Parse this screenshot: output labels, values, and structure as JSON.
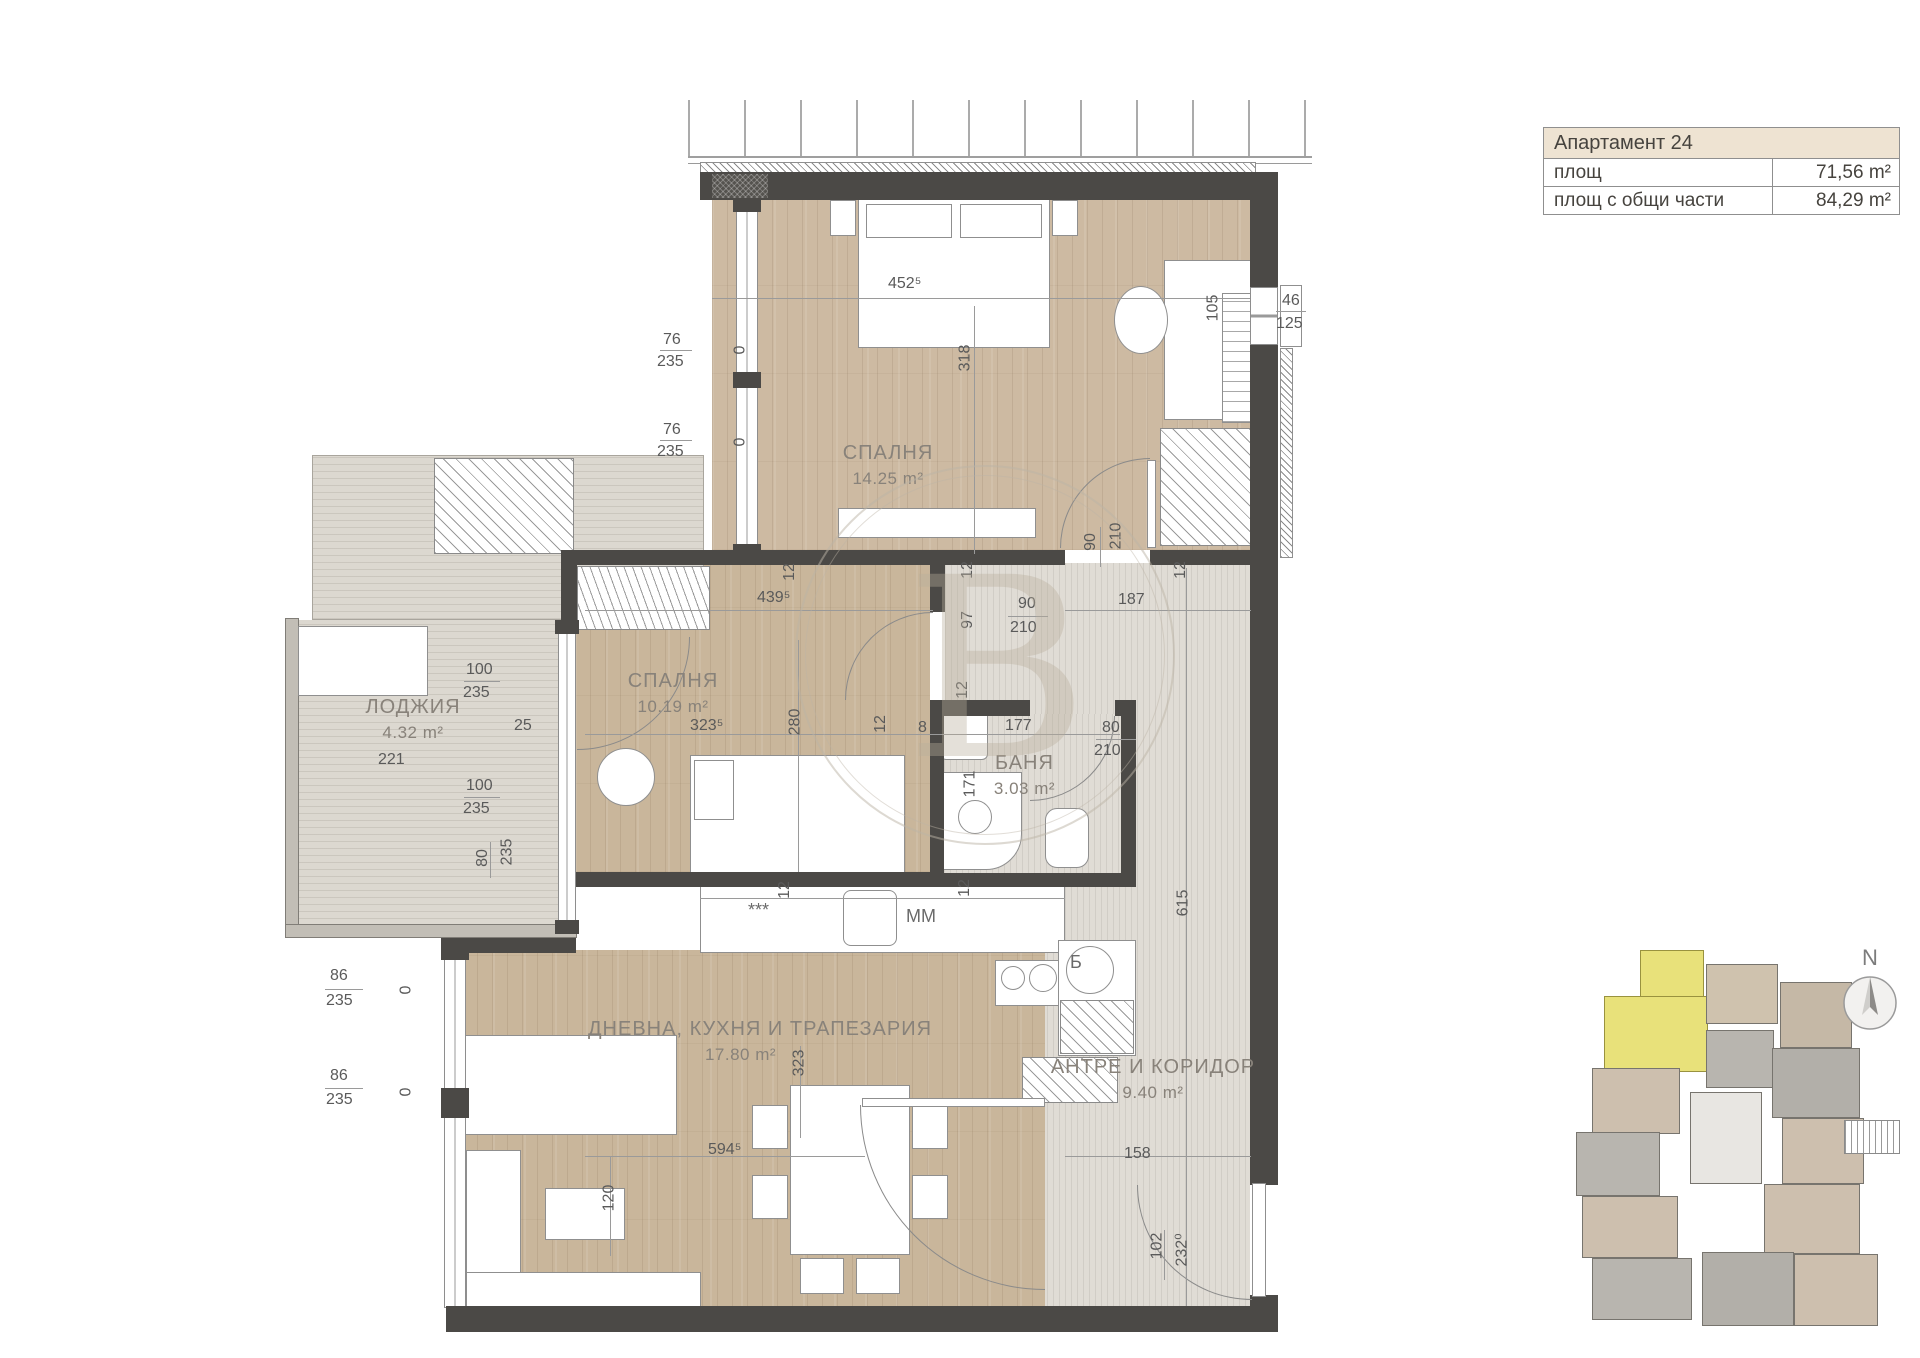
{
  "info_table": {
    "title": "Апартамент 24",
    "rows": [
      {
        "label": "площ",
        "value": "71,56 m²"
      },
      {
        "label": "площ с общи части",
        "value": "84,29 m²"
      }
    ]
  },
  "rooms": {
    "bedroom1": {
      "name": "СПАЛНЯ",
      "area": "14.25 m²"
    },
    "bedroom2": {
      "name": "СПАЛНЯ",
      "area": "10.19 m²"
    },
    "loggia": {
      "name": "ЛОДЖИЯ",
      "area": "4.32 m²"
    },
    "bath": {
      "name": "БАНЯ",
      "area": "3.03 m²"
    },
    "living": {
      "name": "ДНЕВНА, КУХНЯ И ТРАПЕЗАРИЯ",
      "area": "17.80 m²"
    },
    "hall": {
      "name": "АНТРЕ И КОРИДОР",
      "area": "9.40 m²"
    }
  },
  "dims": {
    "bed1_w": "452⁵",
    "bed1_h": "318",
    "desk": "105",
    "win_r_w": "46",
    "win_r_h": "125",
    "win76": "76",
    "win235": "235",
    "zero": "0",
    "bed2_w": "439⁵",
    "bed2_323": "323⁵",
    "bed2_280": "280",
    "door_90": "90",
    "door_210": "210",
    "d12": "12",
    "d97": "97",
    "d187": "187",
    "d615": "615",
    "log_100": "100",
    "log_221": "221",
    "log_25": "25",
    "log_80": "80",
    "bath_8": "8",
    "bath_177": "177",
    "bath_80": "80",
    "bath_210": "210",
    "bath_171": "171",
    "liv_323": "323",
    "liv_594": "594⁵",
    "liv_120": "120",
    "win86": "86",
    "hall_158": "158",
    "hall_102": "102",
    "hall_232": "232⁰"
  },
  "annotations": {
    "dishwasher": "***",
    "washing_machine": "MM",
    "boiler": "Б"
  },
  "minimap": {
    "north": "N"
  },
  "watermark": {
    "letter": "B"
  },
  "colors": {
    "highlight": "#e8e17a",
    "wood": "#c9b69b",
    "wall": "#4b4946",
    "table_header_bg": "#eee3d2"
  }
}
